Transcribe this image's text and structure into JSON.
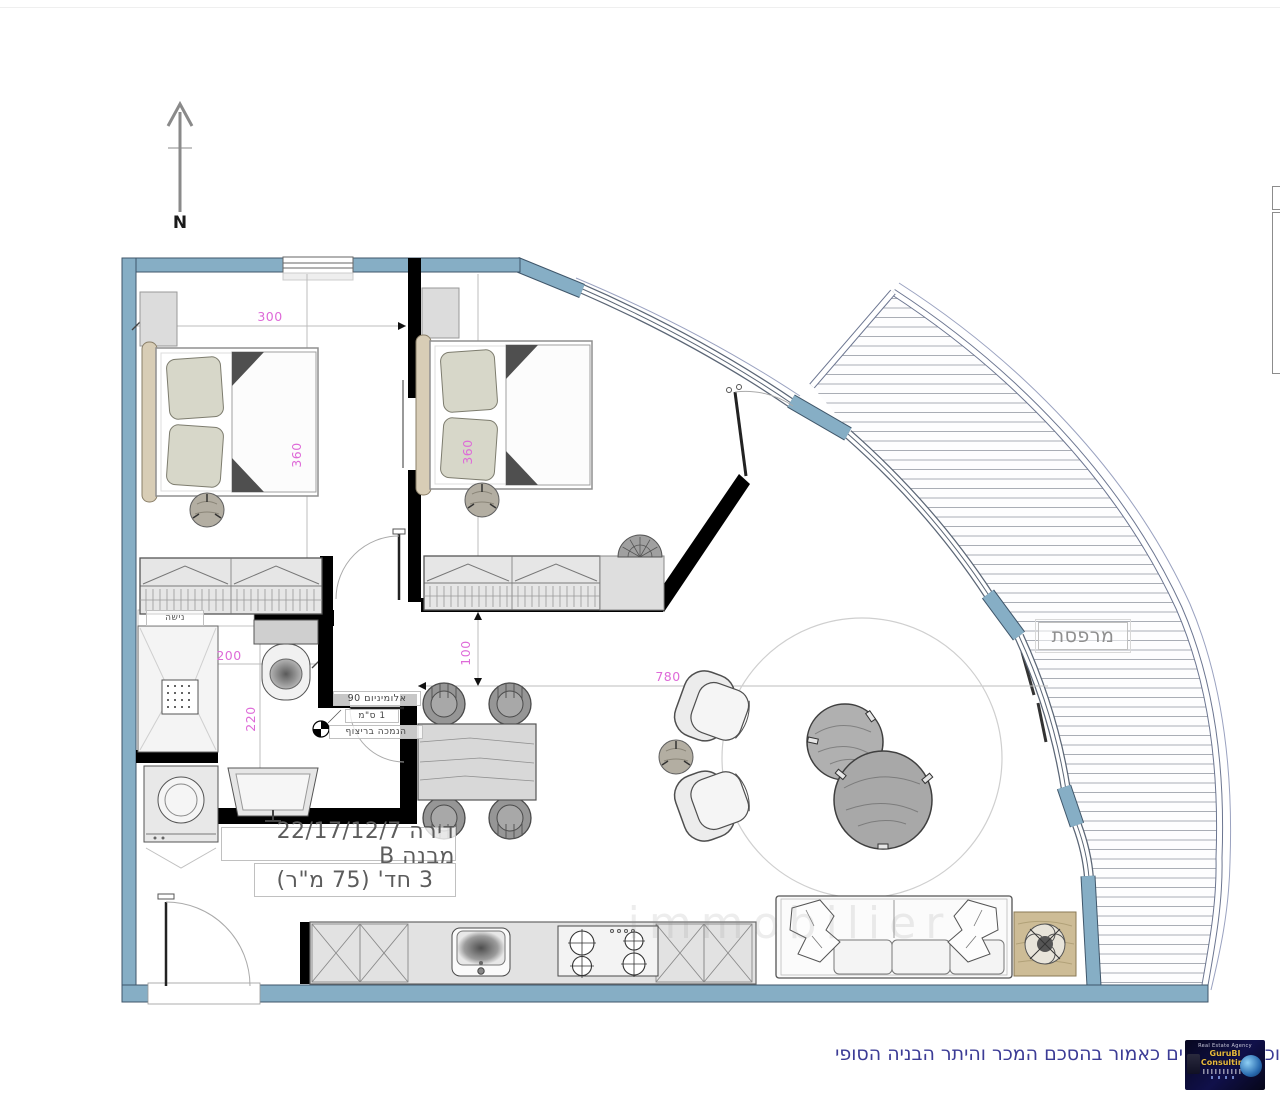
{
  "plan": {
    "north_label": "N",
    "apartment_title_line1": "דירה 22/17/12/7 מבנה B",
    "apartment_title_line2": "3 חד' (75 מ\"ר)",
    "balcony_label": "מרפסת",
    "niche_label": "נישה",
    "threshold_note": {
      "line1": "אלומיניום 90",
      "line2": "1 ס\"מ",
      "line3": "הנמכה בריצוף"
    },
    "dimensions": {
      "top_width_cm": "300",
      "bedroom1_depth_cm": "360",
      "bedroom2_depth_cm": "360",
      "corridor_cm": "100",
      "living_width_cm": "780",
      "bathroom_width_cm": "200",
      "bathroom_depth_cm": "220"
    }
  },
  "footer": {
    "caption_visible_text": "ים כאמור בהסכם המכר והיתר הבניה הסופי",
    "caption_right_fragment": "וכ",
    "caption_color": "#3c3c96"
  },
  "logo": {
    "line1": "Real Estate Agency",
    "line2": "GuruBI Consulting"
  },
  "watermark": "immobilier",
  "colors": {
    "exterior_wall": "#86aec5",
    "interior_wall": "#000000",
    "dimension_label": "#de6ad8",
    "balcony_hatch": "#a9adb5"
  }
}
